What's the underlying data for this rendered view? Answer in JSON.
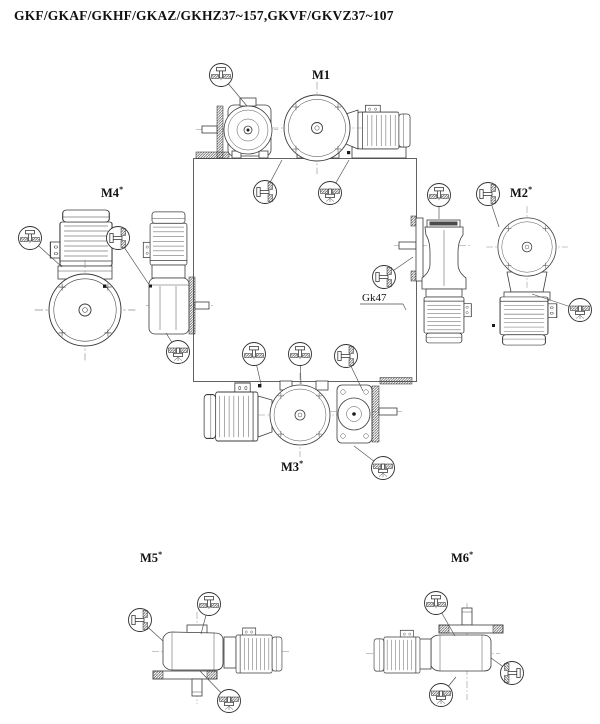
{
  "header": {
    "title": "GKF/GKAF/GKHF/GKAZ/GKHZ37~157,GKVF/GKVZ37~107"
  },
  "diagram": {
    "labels": {
      "m1": {
        "text": "M1",
        "sup": ""
      },
      "m2": {
        "text": "M2",
        "sup": "*"
      },
      "m3": {
        "text": "M3",
        "sup": "*"
      },
      "m4": {
        "text": "M4",
        "sup": "*"
      },
      "m5": {
        "text": "M5",
        "sup": "*"
      },
      "m6": {
        "text": "M6",
        "sup": "*"
      }
    },
    "callout": {
      "gk47": "Gk47"
    }
  },
  "icons": {
    "oil-plug-top-icon": "screw plug entering gear case from above through hatched wall",
    "oil-plug-side-icon": "screw plug entering gear case horizontally through hatched wall",
    "oil-plug-bottom-icon": "screw plug entering gear case from below, hatched wall above"
  },
  "colors": {
    "background": "#ffffff",
    "line": "#3b3b3b",
    "hatch": "#333333",
    "centerline": "#8a8a8a"
  }
}
